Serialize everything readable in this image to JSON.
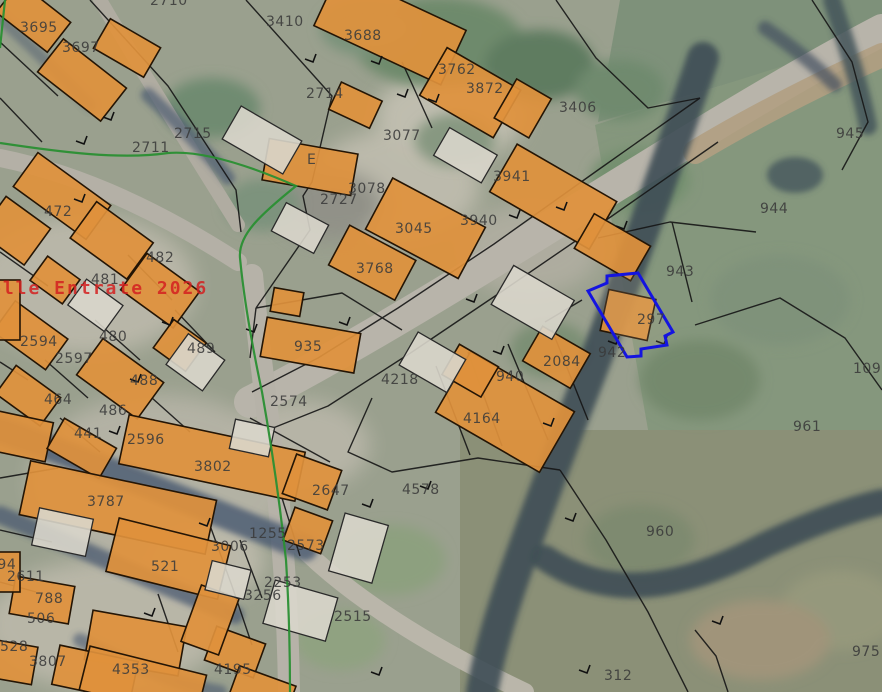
{
  "map": {
    "type": "cadastral-aerial-view",
    "watermark": {
      "text": "elle Entrate 2026",
      "color": "#d42020",
      "x": -10,
      "y": 278
    },
    "highlighted_parcel": {
      "number": "297",
      "outline_color": "#1414e0"
    },
    "colors": {
      "building_fill": "#e0913c",
      "unbuilt_building_fill": "#d9d6cb",
      "parcel_line": "#161616",
      "boundary_green": "#2a8f33",
      "label_text": "#3b3b3b",
      "road": "#b8b4aa",
      "shadow": "#495870",
      "hedge": "#3d4e54"
    },
    "parcel_labels": [
      {
        "t": "3695",
        "x": 20,
        "y": 20
      },
      {
        "t": "3697",
        "x": 62,
        "y": 40
      },
      {
        "t": "2710",
        "x": 150,
        "y": -7
      },
      {
        "t": "3410",
        "x": 266,
        "y": 14
      },
      {
        "t": "3688",
        "x": 344,
        "y": 28
      },
      {
        "t": "2714",
        "x": 306,
        "y": 86
      },
      {
        "t": "2715",
        "x": 174,
        "y": 126
      },
      {
        "t": "2711",
        "x": 132,
        "y": 140
      },
      {
        "t": "3762",
        "x": 438,
        "y": 62
      },
      {
        "t": "3872",
        "x": 466,
        "y": 81
      },
      {
        "t": "3406",
        "x": 559,
        "y": 100
      },
      {
        "t": "945",
        "x": 836,
        "y": 126
      },
      {
        "t": "944",
        "x": 760,
        "y": 201
      },
      {
        "t": "3077",
        "x": 383,
        "y": 128
      },
      {
        "t": "E",
        "x": 307,
        "y": 152
      },
      {
        "t": "3941",
        "x": 493,
        "y": 169
      },
      {
        "t": "3078",
        "x": 348,
        "y": 181
      },
      {
        "t": "2727",
        "x": 320,
        "y": 192
      },
      {
        "t": "3045",
        "x": 395,
        "y": 221
      },
      {
        "t": "3940",
        "x": 460,
        "y": 213
      },
      {
        "t": "3768",
        "x": 356,
        "y": 261
      },
      {
        "t": "472",
        "x": 44,
        "y": 204
      },
      {
        "t": "482",
        "x": 146,
        "y": 250
      },
      {
        "t": "481",
        "x": 91,
        "y": 272
      },
      {
        "t": "2594",
        "x": 20,
        "y": 334
      },
      {
        "t": "480",
        "x": 99,
        "y": 329
      },
      {
        "t": "2597",
        "x": 55,
        "y": 351
      },
      {
        "t": "489",
        "x": 187,
        "y": 341
      },
      {
        "t": "488",
        "x": 130,
        "y": 373
      },
      {
        "t": "464",
        "x": 44,
        "y": 392
      },
      {
        "t": "486",
        "x": 99,
        "y": 403
      },
      {
        "t": "441",
        "x": 74,
        "y": 426
      },
      {
        "t": "2596",
        "x": 127,
        "y": 432
      },
      {
        "t": "935",
        "x": 294,
        "y": 339
      },
      {
        "t": "2574",
        "x": 270,
        "y": 394
      },
      {
        "t": "4218",
        "x": 381,
        "y": 372
      },
      {
        "t": "940",
        "x": 496,
        "y": 369
      },
      {
        "t": "2084",
        "x": 543,
        "y": 354
      },
      {
        "t": "942",
        "x": 598,
        "y": 345
      },
      {
        "t": "943",
        "x": 666,
        "y": 264
      },
      {
        "t": "297",
        "x": 637,
        "y": 312
      },
      {
        "t": "109",
        "x": 853,
        "y": 361
      },
      {
        "t": "961",
        "x": 793,
        "y": 419
      },
      {
        "t": "4164",
        "x": 463,
        "y": 411
      },
      {
        "t": "4578",
        "x": 402,
        "y": 482
      },
      {
        "t": "2647",
        "x": 312,
        "y": 483
      },
      {
        "t": "960",
        "x": 646,
        "y": 524
      },
      {
        "t": "3802",
        "x": 194,
        "y": 459
      },
      {
        "t": "3787",
        "x": 87,
        "y": 494
      },
      {
        "t": "521",
        "x": 151,
        "y": 559
      },
      {
        "t": "3006",
        "x": 211,
        "y": 539
      },
      {
        "t": "1255",
        "x": 249,
        "y": 526
      },
      {
        "t": "2573",
        "x": 287,
        "y": 538
      },
      {
        "t": "2253",
        "x": 264,
        "y": 575
      },
      {
        "t": "3256",
        "x": 244,
        "y": 588
      },
      {
        "t": "2611",
        "x": 7,
        "y": 569
      },
      {
        "t": "494",
        "x": -12,
        "y": 557
      },
      {
        "t": "788",
        "x": 35,
        "y": 591
      },
      {
        "t": "506",
        "x": 27,
        "y": 611
      },
      {
        "t": "528",
        "x": 0,
        "y": 639
      },
      {
        "t": "3807",
        "x": 29,
        "y": 654
      },
      {
        "t": "4353",
        "x": 112,
        "y": 662
      },
      {
        "t": "4195",
        "x": 214,
        "y": 662
      },
      {
        "t": "2515",
        "x": 334,
        "y": 609
      },
      {
        "t": "312",
        "x": 604,
        "y": 668
      },
      {
        "t": "975",
        "x": 852,
        "y": 644
      }
    ]
  }
}
